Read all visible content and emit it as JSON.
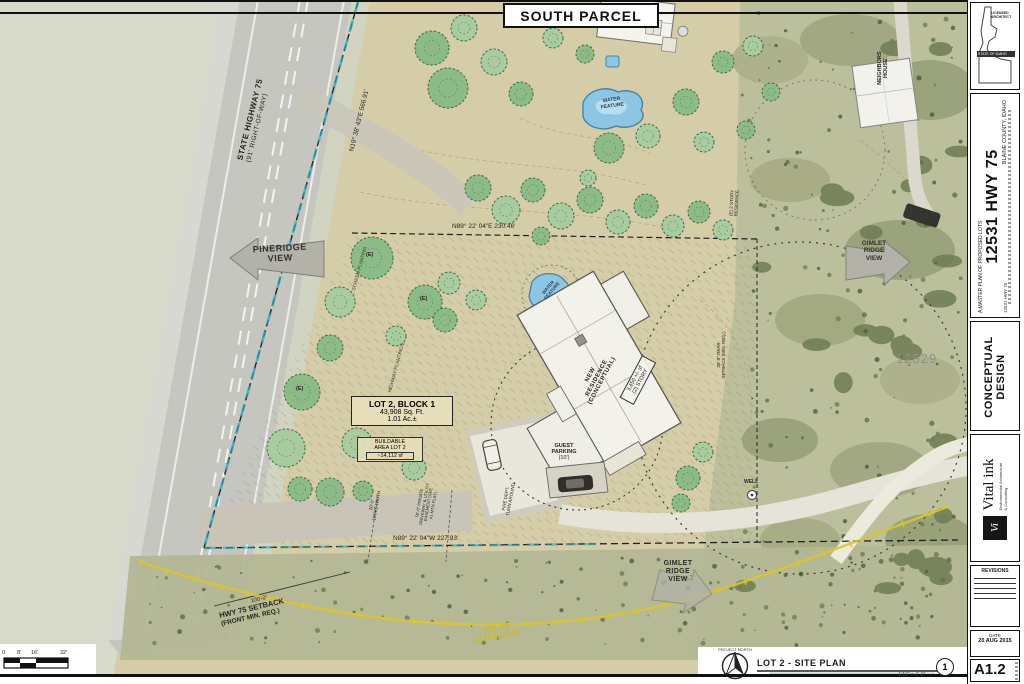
{
  "sheet": {
    "title": "SOUTH PARCEL",
    "project_north": "PROJECT NORTH",
    "drawing_title": "LOT 2 - SITE PLAN",
    "drawing_scale": "1/16\" = 1'-0\"",
    "detail_number": "1",
    "scale_ticks": [
      "0",
      "8'",
      "16'",
      "32'"
    ]
  },
  "titleblock": {
    "stamp_line1": "LICENSED ARCHITECT",
    "stamp_line2": "STATE OF IDAHO",
    "series_label": "A MASTER PLAN OF PROPOSED LOTS",
    "project_title": "12531 HWY 75",
    "project_location": "BLAINE COUNTY, IDAHO",
    "project_ref": "12531 HWY 75",
    "phase_line1": "CONCEPTUAL",
    "phase_line2": "DESIGN",
    "firm_name": "Vital ink",
    "firm_sub1": "Environmental Architecture",
    "firm_sub2": "& Consulting",
    "firm_mark": "Vi",
    "revisions_label": "REVISIONS",
    "date_label": "DATE",
    "date_value": "20 AUG 2015",
    "sheet_number": "A1.2"
  },
  "plan": {
    "highway_name": "STATE HIGHWAY 75",
    "highway_row": "(91' RIGHT-OF-WAY)",
    "bearing_road": "N19° 38' 43\"E  566.91'",
    "bearing_north": "N89° 22' 04\"E  230.46'",
    "bearing_south": "N89° 22' 04\"W  227.93'",
    "pineridge": [
      "PINERIDGE",
      "VIEW"
    ],
    "gimlet": [
      "GIMLET",
      "RIDGE",
      "VIEW"
    ],
    "lot_title": "LOT 2, BLOCK 1",
    "lot_area": "43,908 Sq. Ft.",
    "lot_acres": "1.01 Ac.±",
    "buildable": [
      "BUILDABLE",
      "AREA LOT 2",
      "~14,112 sf"
    ],
    "residence": [
      "NEW",
      "RESIDENCE",
      "(CONCEPTUAL)"
    ],
    "residence_size": [
      "3,450 +/- sf",
      "(2) STORY"
    ],
    "guest_parking": [
      "GUEST",
      "PARKING",
      "(10')"
    ],
    "water_feature": [
      "WATER",
      "FEATURE"
    ],
    "neighbors": [
      "NEIGHBORS",
      "HOUSE"
    ],
    "address_adjacent": "12529",
    "setback_dim": "100'-0\"",
    "setback_line1": "HWY 75 SETBACK",
    "setback_line2": "(FRONT MIN. REQ.)",
    "rear_setback": [
      "30'-0\" REAR",
      "SETBACK (MIN. REQ.)"
    ],
    "screen_planting": "SCREEN PLANTING",
    "highway_plantings": "HIGHWAY PLANTINGS",
    "fire_dept": [
      "FIRE DEPT.",
      "TURN AROUND"
    ],
    "drive_width": [
      "20'-0\"",
      "DRIVE WIDTH"
    ],
    "easement": [
      "50'-0\" PRIVATE",
      "DRIVEWAY & UTILITY",
      "EASEMENT (SEE",
      "#1 MTN PLAT)"
    ],
    "existing_res": [
      "(E) 2 STORY",
      "RESIDENCE"
    ],
    "existing_mark": "(E)",
    "well": "WELL",
    "solar": [
      "SOLAR",
      "EXPOSURE"
    ]
  },
  "colors": {
    "boundary_teal": "#2aa7b8",
    "solar_yellow": "#d9c52f",
    "pond_blue": "#8cc6e2",
    "tree_green": "#8bbc88",
    "ground_tan": "#d5cda8"
  }
}
